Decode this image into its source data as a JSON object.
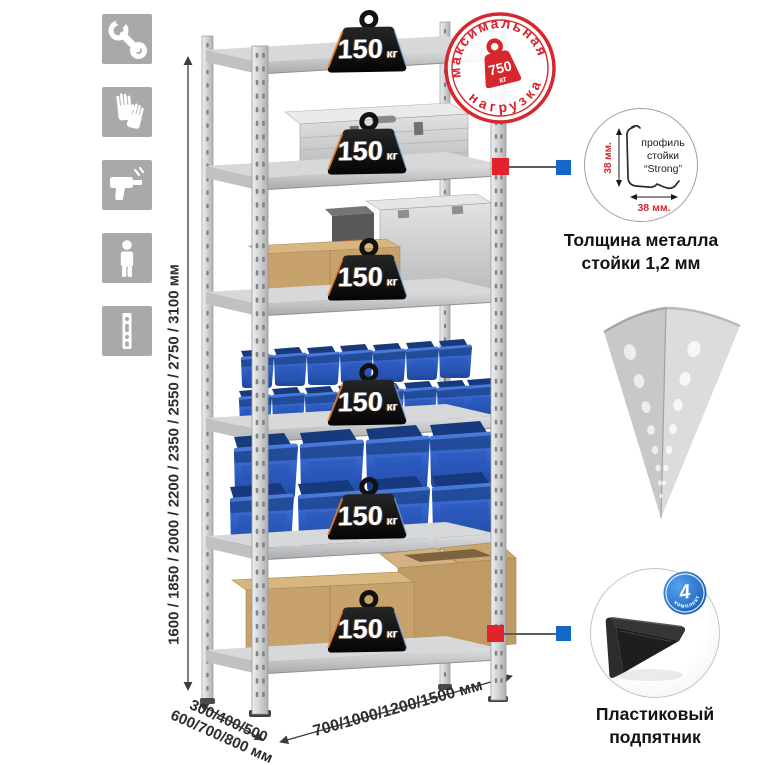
{
  "colors": {
    "accent_red": "#e2232b",
    "accent_blue": "#1566c9",
    "stamp_red": "#d6262e",
    "bin_blue": "#2e5ec6",
    "icon_gray": "#a9a9a9"
  },
  "left_icons": [
    {
      "name": "wrench-icon"
    },
    {
      "name": "gloves-icon"
    },
    {
      "name": "drill-icon"
    },
    {
      "name": "person-icon"
    },
    {
      "name": "rack-post-icon"
    }
  ],
  "dimensions": {
    "height_options": "1600 / 1850 / 2000 / 2200 / 2350 / 2550 / 2750 / 3100 мм",
    "depth_options_line1": "300/400/500",
    "depth_options_line2": "600/700/800 мм",
    "width_options": "700/1000/1200/1500 мм"
  },
  "shelves": [
    {
      "load": "150",
      "unit": "кг"
    },
    {
      "load": "150",
      "unit": "кг"
    },
    {
      "load": "150",
      "unit": "кг"
    },
    {
      "load": "150",
      "unit": "кг"
    },
    {
      "load": "150",
      "unit": "кг"
    },
    {
      "load": "150",
      "unit": "кг"
    }
  ],
  "max_load_stamp": {
    "text_top": "максимальная",
    "text_bottom": "нагрузка",
    "value": "750",
    "unit": "кг"
  },
  "profile_detail": {
    "label_line1": "профиль",
    "label_line2": "стойки",
    "label_line3": "“Strong”",
    "dim_vertical": "38 мм.",
    "dim_horizontal": "38 мм.",
    "caption_line1": "Толщина металла",
    "caption_line2": "стойки 1,2 мм"
  },
  "foot_detail": {
    "badge_value": "4",
    "badge_text": "в комплекте",
    "caption_line1": "Пластиковый",
    "caption_line2": "подпятник"
  }
}
